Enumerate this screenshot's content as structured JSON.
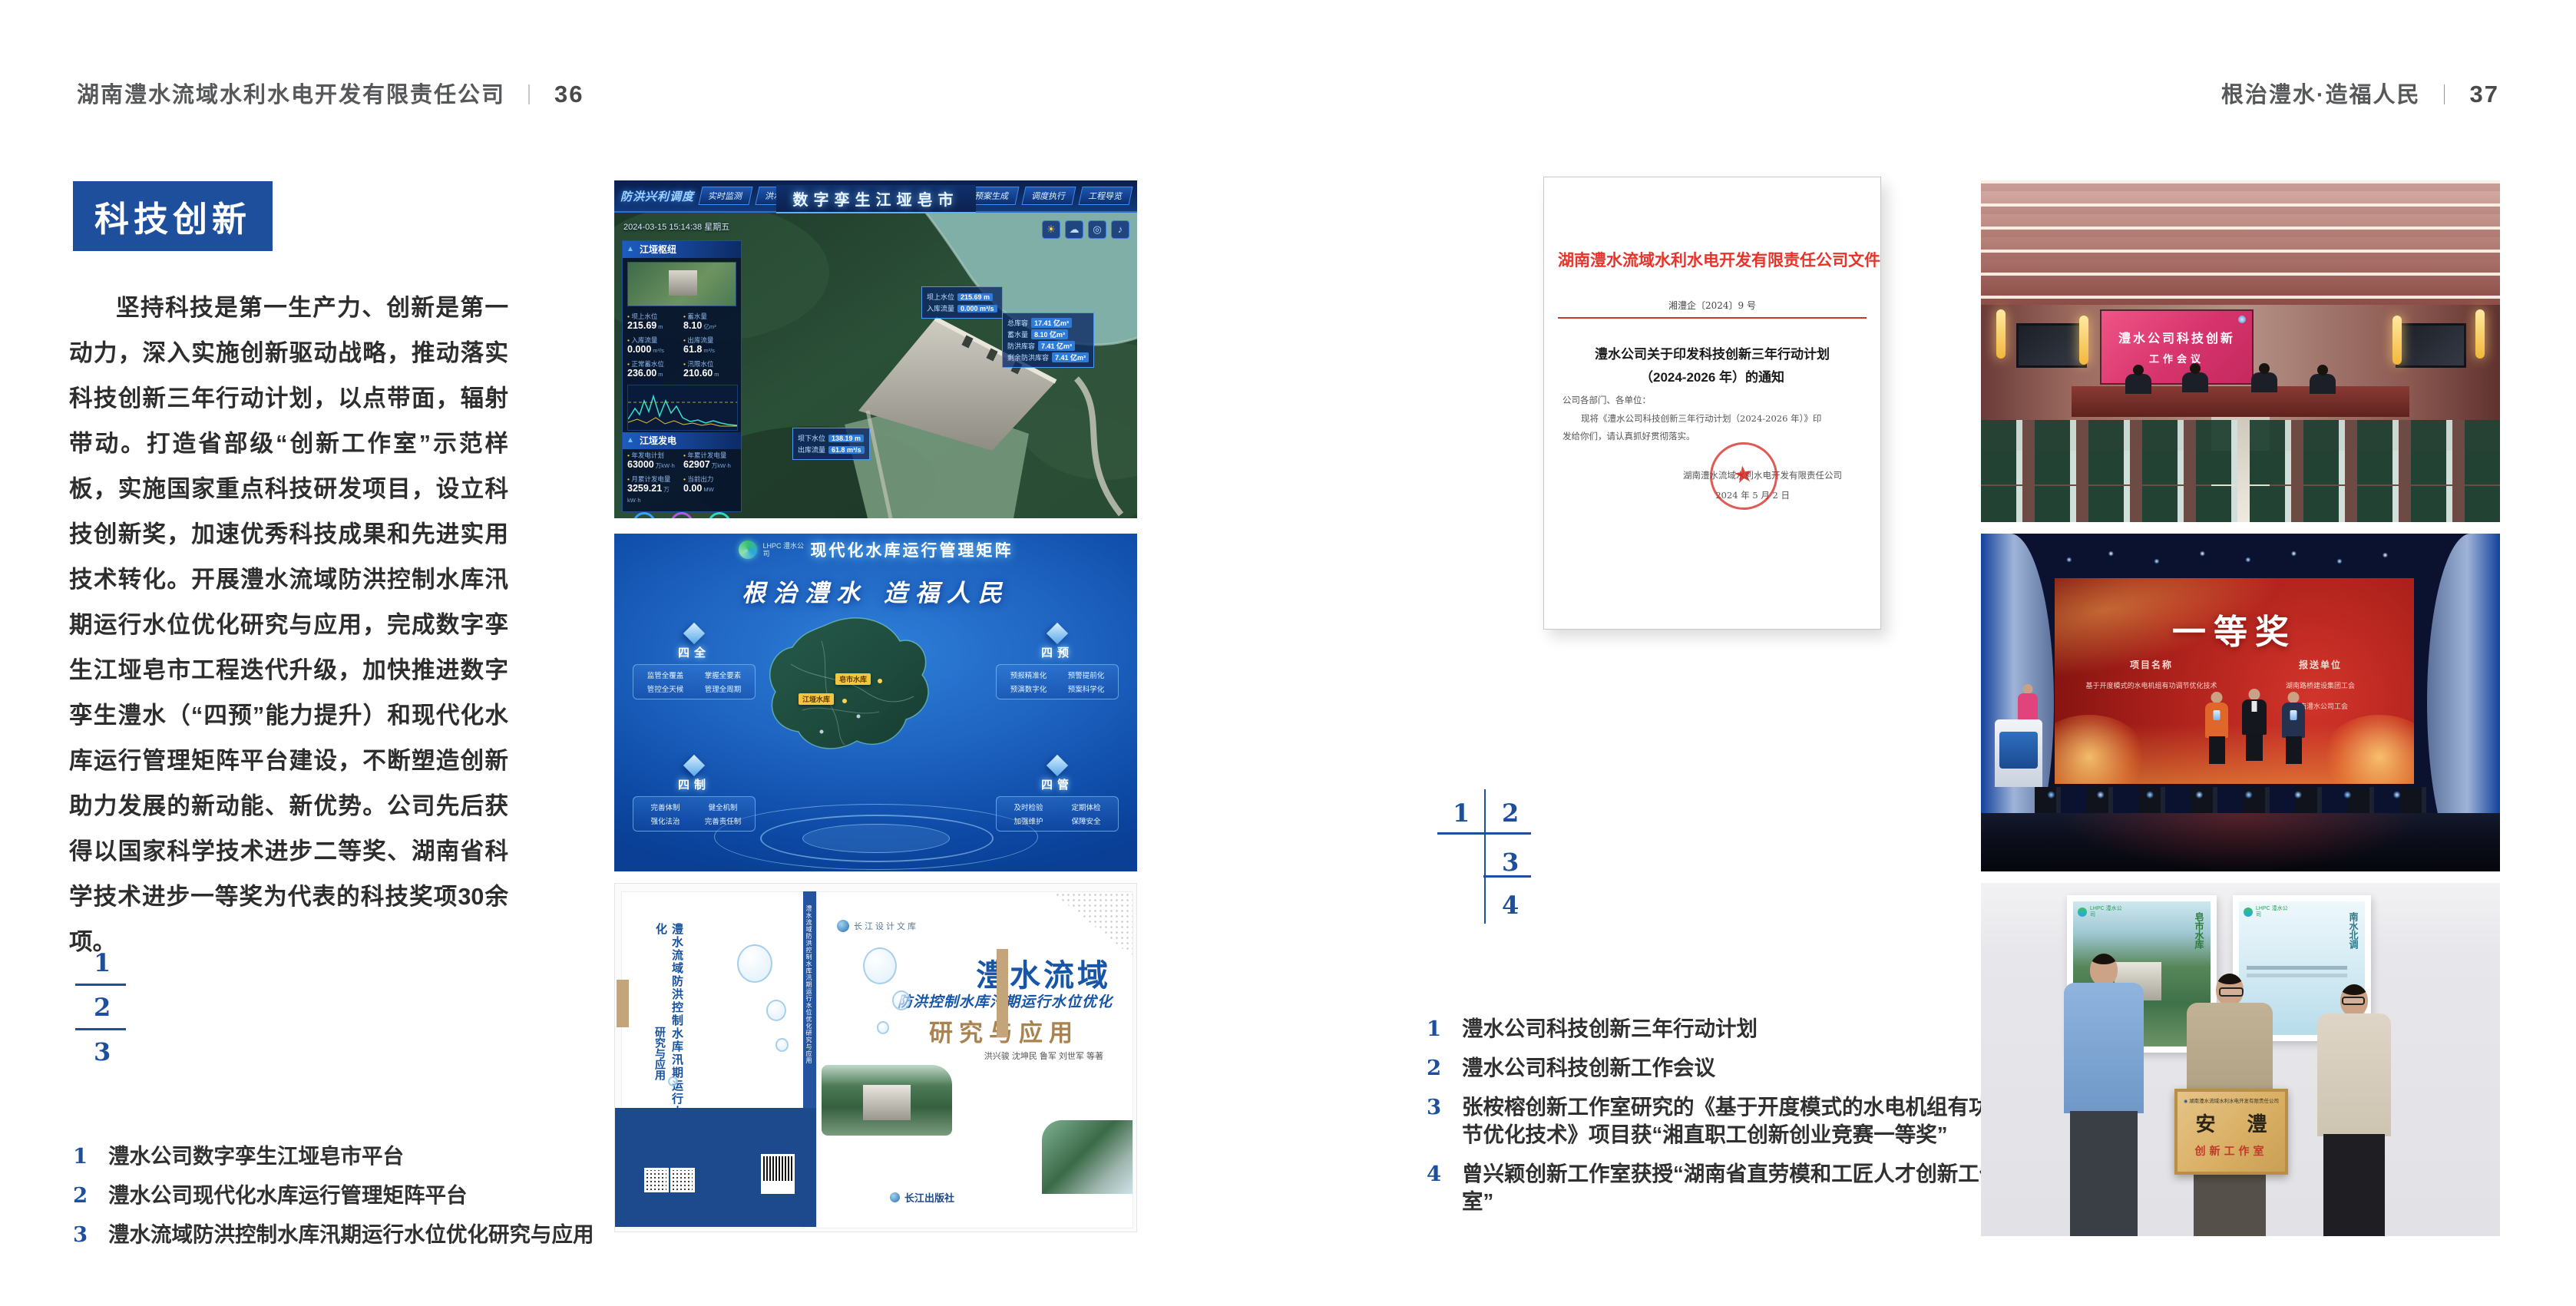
{
  "header_left": {
    "title": "湖南澧水流域水利水电开发有限责任公司",
    "divider": "｜",
    "page_no": "36"
  },
  "header_right": {
    "title": "根治澧水·造福人民",
    "divider": "｜",
    "page_no": "37"
  },
  "accent_color": "#1d4f9c",
  "left_page": {
    "section_title": "科技创新",
    "paragraph": "坚持科技是第一生产力、创新是第一动力，深入实施创新驱动战略，推动落实科技创新三年行动计划，以点带面，辐射带动。打造省部级“创新工作室”示范样板，实施国家重点科技研发项目，设立科技创新奖，加速优秀科技成果和先进实用技术转化。开展澧水流域防洪控制水库汛期运行水位优化研究与应用，完成数字孪生江垭皂市工程迭代升级，加快推进数字孪生澧水（“四预”能力提升）和现代化水库运行管理矩阵平台建设，不断塑造创新助力发展的新动能、新优势。公司先后获得以国家科学技术进步二等奖、湖南省科学技术进步一等奖为代表的科技奖项30余项。",
    "figure_keys": [
      "1",
      "2",
      "3"
    ],
    "captions": [
      {
        "no": "1",
        "text": "澧水公司数字孪生江垭皂市平台"
      },
      {
        "no": "2",
        "text": "澧水公司现代化水库运行管理矩阵平台"
      },
      {
        "no": "3",
        "text": "澧水流域防洪控制水库汛期运行水位优化研究与应用"
      }
    ]
  },
  "right_page": {
    "figure_keys": [
      "1",
      "2",
      "3",
      "4"
    ],
    "captions": [
      {
        "no": "1",
        "text": "澧水公司科技创新三年行动计划"
      },
      {
        "no": "2",
        "text": "澧水公司科技创新工作会议"
      },
      {
        "no": "3",
        "text": "张桉榕创新工作室研究的《基于开度模式的水电机组有功调节优化技术》项目获“湘直职工创新创业竞赛一等奖”"
      },
      {
        "no": "4",
        "text": "曾兴颖创新工作室获授“湖南省直劳模和工匠人才创新工作室”"
      }
    ]
  },
  "dashboard": {
    "system_label": "防洪兴利调度",
    "title": "数字孪生江垭皂市",
    "tabs_left": [
      "实时监测",
      "洪水预报",
      "防洪预演"
    ],
    "tabs_right": [
      "暴雨预测",
      "预案生成",
      "调度执行",
      "工程导览"
    ],
    "datetime": "2024-03-15 15:14:38 星期五",
    "panel1_title": "江垭枢纽",
    "stats1": [
      {
        "label": "坝上水位",
        "value": "215.69",
        "unit": "m"
      },
      {
        "label": "蓄水量",
        "value": "8.10",
        "unit": "亿m³"
      },
      {
        "label": "入库流量",
        "value": "0.000",
        "unit": "m³/s"
      },
      {
        "label": "出库流量",
        "value": "61.8",
        "unit": "m³/s"
      },
      {
        "label": "正常蓄水位",
        "value": "236.00",
        "unit": "m"
      },
      {
        "label": "汛限水位",
        "value": "210.60",
        "unit": "m"
      }
    ],
    "panel2_title": "江垭发电",
    "stats2": [
      {
        "label": "年发电计划",
        "value": "63000",
        "unit": "万kW·h"
      },
      {
        "label": "年累计发电量",
        "value": "62907",
        "unit": "万kW·h"
      },
      {
        "label": "月累计发电量",
        "value": "3259.21",
        "unit": "万kW·h"
      },
      {
        "label": "当前出力",
        "value": "0.00",
        "unit": "MW"
      }
    ],
    "callout1": [
      {
        "label": "坝上水位",
        "value": "215.69 m"
      },
      {
        "label": "入库流量",
        "value": "0.000 m³/s"
      }
    ],
    "callout2": [
      {
        "label": "总库容",
        "value": "17.41 亿m³"
      },
      {
        "label": "蓄水量",
        "value": "8.10 亿m³"
      },
      {
        "label": "防洪库容",
        "value": "7.41 亿m³"
      },
      {
        "label": "剩余防洪库容",
        "value": "7.41 亿m³"
      }
    ],
    "callout3": [
      {
        "label": "坝下水位",
        "value": "138.19 m"
      },
      {
        "label": "出库流量",
        "value": "61.8 m³/s"
      }
    ]
  },
  "platform": {
    "logo_text": "LHPC 澧水公司",
    "title": "现代化水库运行管理矩阵",
    "slogan": "根治澧水 造福人民",
    "map_labels": [
      "皂市水库",
      "江垭水库"
    ],
    "groups": [
      {
        "title": "四全",
        "items": [
          "监管全覆盖",
          "掌握全要素",
          "管控全天候",
          "管理全周期"
        ]
      },
      {
        "title": "四预",
        "items": [
          "预报精准化",
          "预警提前化",
          "预演数字化",
          "预案科学化"
        ]
      },
      {
        "title": "四制",
        "items": [
          "完善体制",
          "健全机制",
          "强化法治",
          "完善责任制"
        ]
      },
      {
        "title": "四管",
        "items": [
          "及时检验",
          "定期体检",
          "加强维护",
          "保障安全"
        ]
      }
    ]
  },
  "book": {
    "series_logo": "长江设计文库",
    "title_main": "澧水流域",
    "title_sub": "防洪控制水库汛期运行水位优化",
    "title_tail": "研究与应用",
    "authors": "洪兴骏  沈坤民  鲁军  刘世军  等著",
    "publisher": "长江出版社",
    "spine_text": "澧水流域防洪控制水库汛期运行水位优化研究与应用",
    "back_title": "澧水流域防洪控制水库汛期运行水位优化",
    "back_tail": "研究与应用"
  },
  "document": {
    "header": "湖南澧水流域水利水电开发有限责任公司文件",
    "doc_no": "湘澧企〔2024〕9 号",
    "title_line1": "澧水公司关于印发科技创新三年行动计划",
    "title_line2": "（2024-2026 年）的通知",
    "salutation": "公司各部门、各单位：",
    "body_line1": "现将《澧水公司科技创新三年行动计划（2024-2026 年）》印",
    "body_line2": "发给你们，请认真抓好贯彻落实。",
    "signer": "湖南澧水流域水利水电开发有限责任公司",
    "date": "2024 年 5 月 2 日"
  },
  "meeting": {
    "screen_line1": "澧水公司科技创新",
    "screen_line2": "工作会议"
  },
  "award": {
    "title": "一等奖",
    "col1_header": "项目名称",
    "col2_header": "报送单位",
    "col1_lines": [
      "基于开度模式的水电机组有功调节优化技术"
    ],
    "col2_lines": [
      "湖南路桥建设集团工会",
      "湖南澧水公司工会"
    ]
  },
  "plaque": {
    "poster_logo": "LHPC 澧水公司",
    "poster_left_label": "皂市水库",
    "poster_right_label": "南水北调",
    "plaque_top": "湖南澧水流域水利水电开发有限责任公司",
    "plaque_main": "安 澧",
    "plaque_sub": "创新工作室"
  }
}
